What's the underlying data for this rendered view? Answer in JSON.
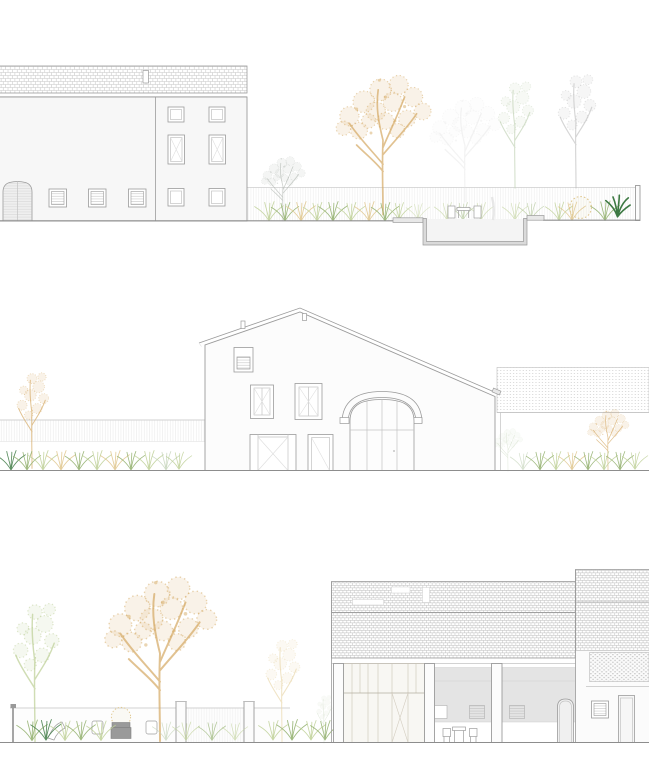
{
  "document": {
    "title": "Architectural elevation sheet — three garden elevations",
    "type": "elevation-triptych",
    "visible_text": []
  },
  "palette": {
    "line": "#9b9b9b",
    "line_soft": "#c3c3c3",
    "line_faint": "#dedede",
    "facade": "#f7f7f7",
    "facade_bright": "#fcfcfc",
    "recess": "#e4e4e4",
    "slab": "#e8e8e8",
    "pool_wall": "#dadada",
    "pool_basin": "#f4f4f4",
    "roof_hatch": "#c6c6c6",
    "roof_hatch_dark": "#bdbdbd",
    "dots": "#c9c9c9",
    "gold": "#d5ab66",
    "gold_soft": "#dfc68c",
    "gold_faint": "#ead9b0",
    "green": "#8fae6a",
    "green_light": "#bed097",
    "green_dark": "#3e7a44",
    "sage": "#c6d5bb",
    "gray_veg": "#b7bdb7",
    "gray_tree": "#bcbcbc",
    "furniture": "#9e9e9e"
  },
  "sections": [
    {
      "id": "elevation-top",
      "label": "Elevation 1 — long two-storey building with tiled roof, arched gate, louvered windows, garden wall, golden tree, ornamental grasses and sunken pool section",
      "elements": [
        "tiled-roof",
        "roof-vent",
        "arched-gate",
        "louver-windows",
        "double-frame-windows",
        "garden-wall",
        "gray-tree",
        "golden-tree",
        "sage-tree",
        "grass-border",
        "pool-deck",
        "sunken-pool",
        "pool-furniture",
        "agave-plant",
        "gold-shrub"
      ]
    },
    {
      "id": "elevation-middle",
      "label": "Elevation 2 — gabled farmhouse with arched entrance, attic window, tall windows, glazed doors, hatched fence, golden trees and grass borders, low outbuilding with dotted tile roof",
      "elements": [
        "gabled-roof",
        "chimneys",
        "attic-window",
        "tall-windows",
        "arched-entrance",
        "glazed-door",
        "side-door",
        "hatched-fence",
        "golden-tree-left",
        "golden-tree-right",
        "grass-border",
        "outbuilding-roof"
      ]
    },
    {
      "id": "elevation-bottom",
      "label": "Elevation 3 — garden with green and golden trees, walled terrace with outdoor furniture, courtyard barn with hatched tile roof, skylights, timber glazed bay, portico columns, louver vents, arched door and brick-lattice gable block",
      "elements": [
        "green-tree",
        "large-golden-tree",
        "faint-golden-tree",
        "garden-wall",
        "wall-posts",
        "lamp-post",
        "lounge-chair",
        "armchairs",
        "bench",
        "round-shrub",
        "grass-border",
        "barn-roof",
        "roof-skylights",
        "timber-glazed-bay",
        "portico-columns",
        "recessed-wall",
        "louver-vents",
        "arched-door",
        "patio-table-chairs",
        "lattice-gable-block",
        "louver-window",
        "side-door"
      ]
    }
  ]
}
